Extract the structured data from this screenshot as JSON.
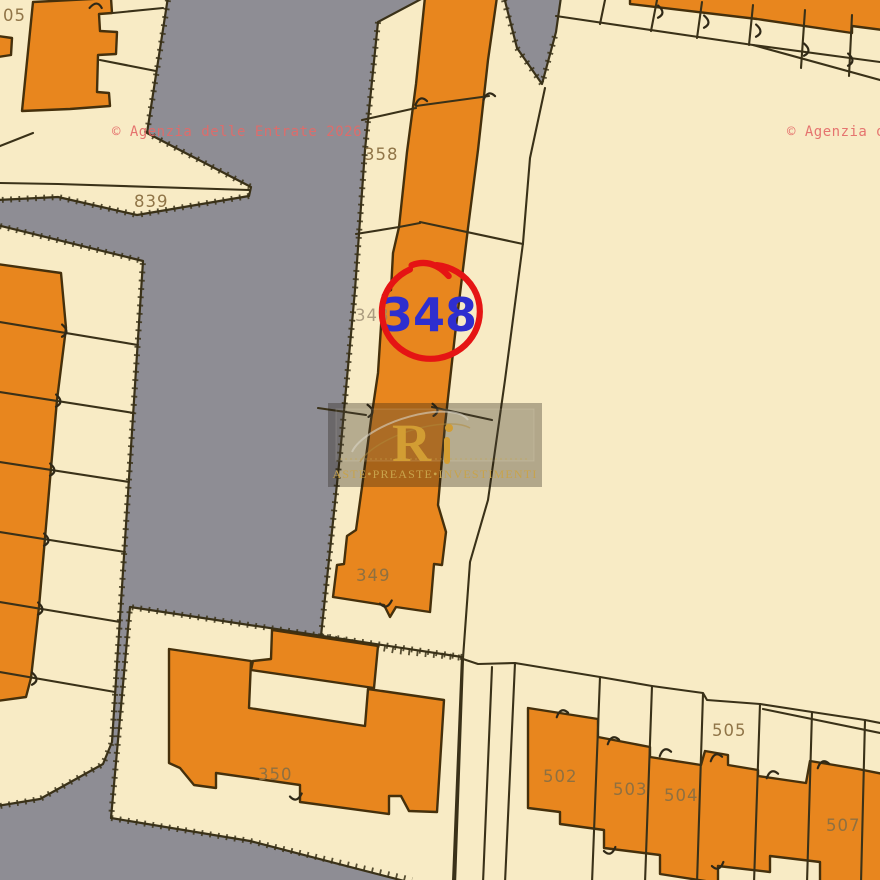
{
  "watermarks": {
    "agency_left": "© Agenzia delle Entrate 2026",
    "agency_right": "© Agenzia d",
    "color": "#e46a68"
  },
  "stamp": {
    "number": "348",
    "text_color": "#2e2ecf",
    "circle_color": "#e51414"
  },
  "logo": {
    "monogram": "R",
    "brand": "ASTE•PREASTE•INVESTIMENTI",
    "gold": "#d29d33"
  },
  "colors": {
    "road": "#8e8d94",
    "parcel_fill": "#f8ebc5",
    "building_fill": "#e8861e",
    "boundary": "#3a3118",
    "label": "#8b6f42"
  },
  "parcels": [
    {
      "label": "05"
    },
    {
      "label": "839"
    },
    {
      "label": "358"
    },
    {
      "label": "348"
    },
    {
      "label": "349"
    },
    {
      "label": "350"
    },
    {
      "label": "502"
    },
    {
      "label": "503"
    },
    {
      "label": "504"
    },
    {
      "label": "505"
    },
    {
      "label": "507"
    }
  ]
}
